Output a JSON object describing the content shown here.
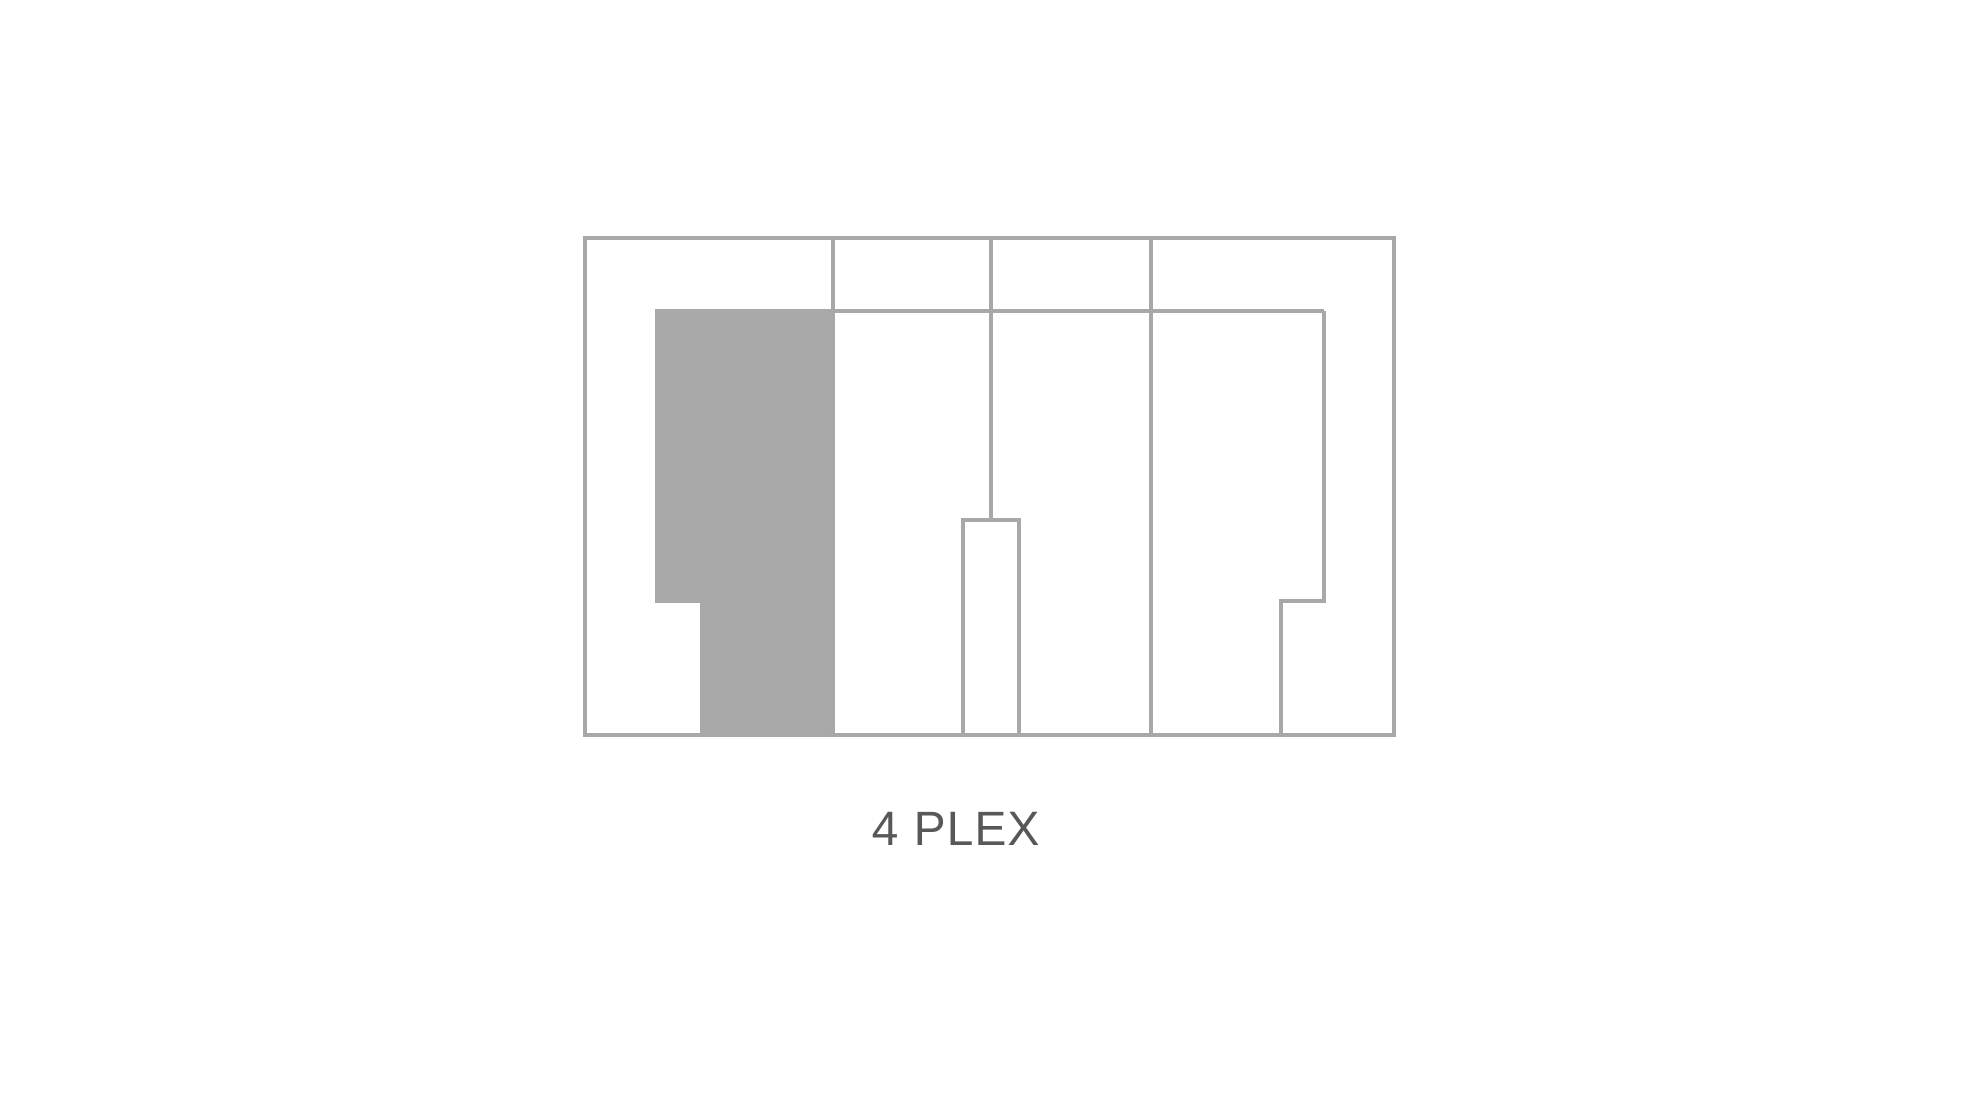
{
  "page": {
    "background": "#ffffff"
  },
  "theme": {
    "line_color": "#a8a8a8",
    "unit_fill": "#a9a9a9",
    "label_color": "#58585a"
  },
  "diagram": {
    "label": "4 PLEX"
  }
}
